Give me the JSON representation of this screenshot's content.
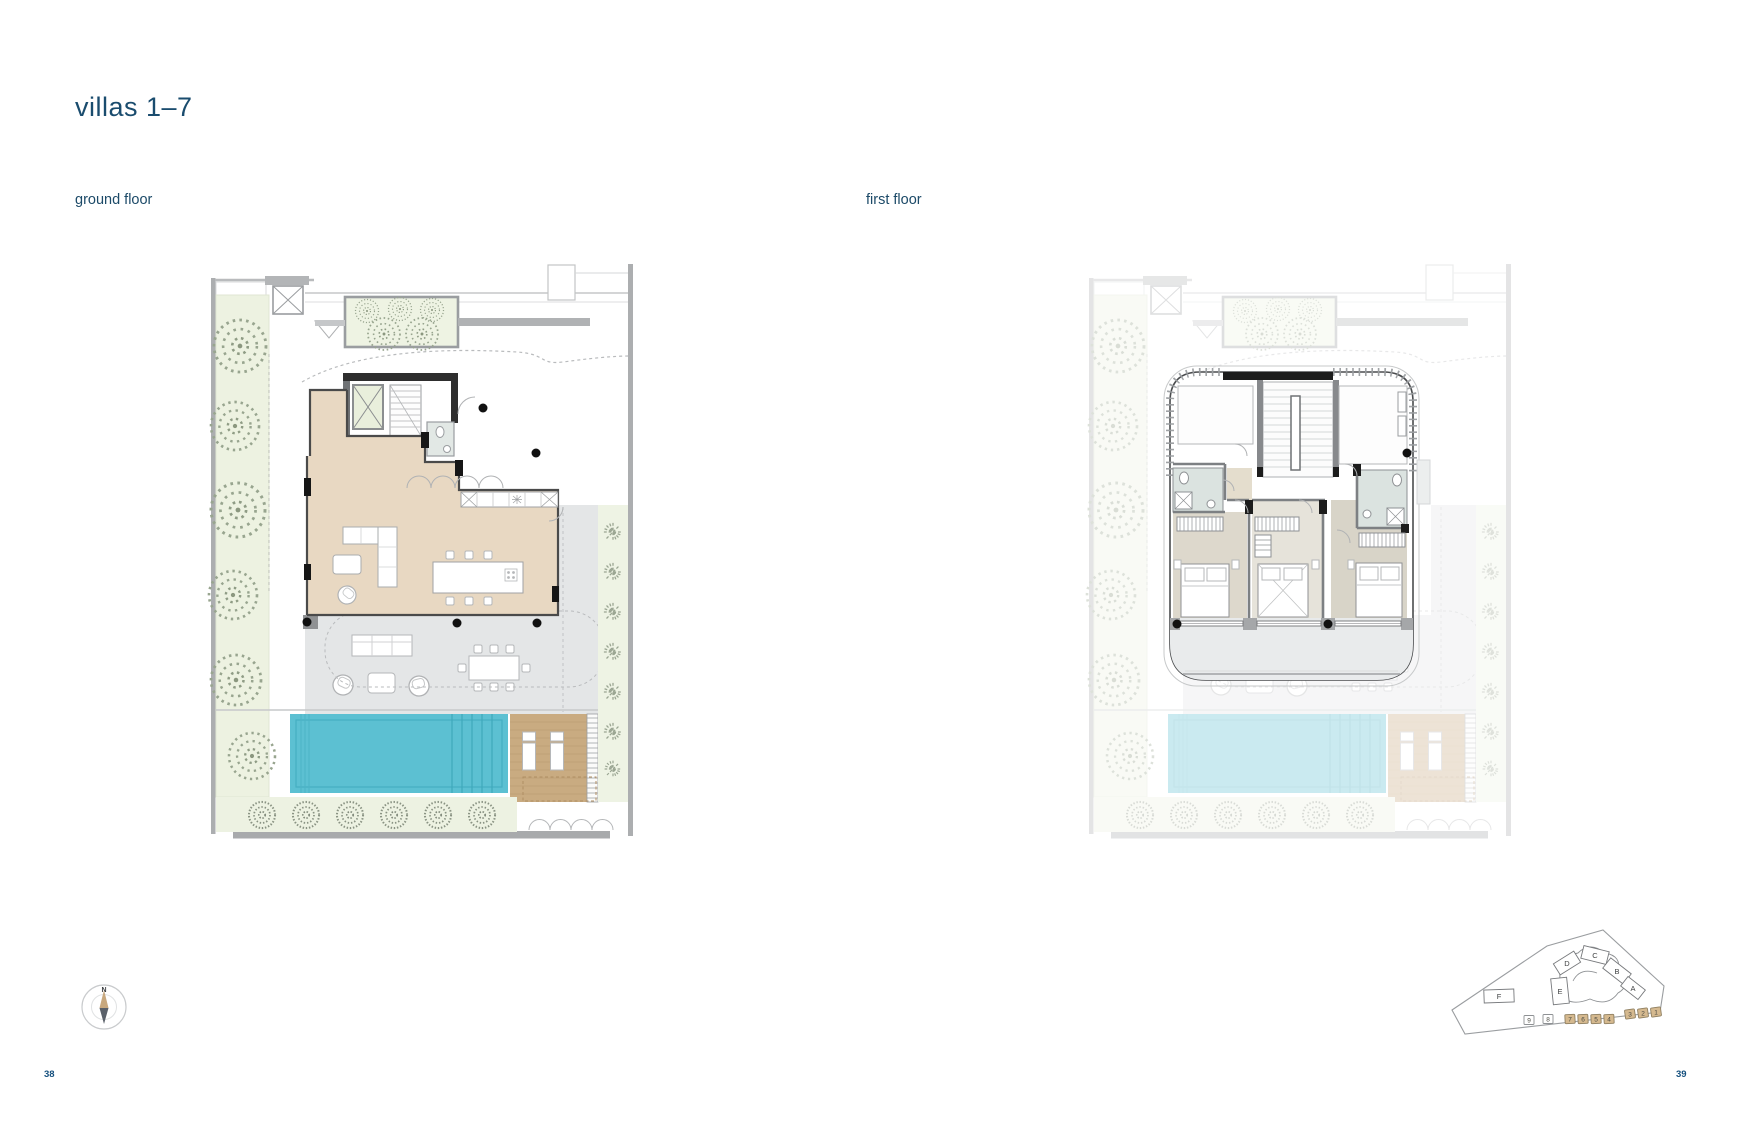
{
  "page": {
    "title": "villas 1–7",
    "left_page_number": "38",
    "right_page_number": "39"
  },
  "plans": {
    "ground": {
      "label": "ground floor"
    },
    "first": {
      "label": "first floor"
    }
  },
  "compass": {
    "north_label": "N"
  },
  "sitemap": {
    "buildings": [
      {
        "label": "A"
      },
      {
        "label": "B"
      },
      {
        "label": "C"
      },
      {
        "label": "D"
      },
      {
        "label": "E"
      },
      {
        "label": "F"
      }
    ],
    "units": [
      {
        "label": "9",
        "highlighted": false
      },
      {
        "label": "8",
        "highlighted": false
      },
      {
        "label": "7",
        "highlighted": true
      },
      {
        "label": "6",
        "highlighted": true
      },
      {
        "label": "5",
        "highlighted": true
      },
      {
        "label": "4",
        "highlighted": true
      },
      {
        "label": "3",
        "highlighted": true
      },
      {
        "label": "2",
        "highlighted": true
      },
      {
        "label": "1",
        "highlighted": true
      }
    ]
  },
  "colors": {
    "title_text": "#1a4c6e",
    "pool": "#5cc0d2",
    "interior_floor": "#e8d8c2",
    "deck": "#c9ab81",
    "garden": "#edf2e1",
    "terrace": "#e4e6e7",
    "unit_highlight": "#d5b98f"
  }
}
